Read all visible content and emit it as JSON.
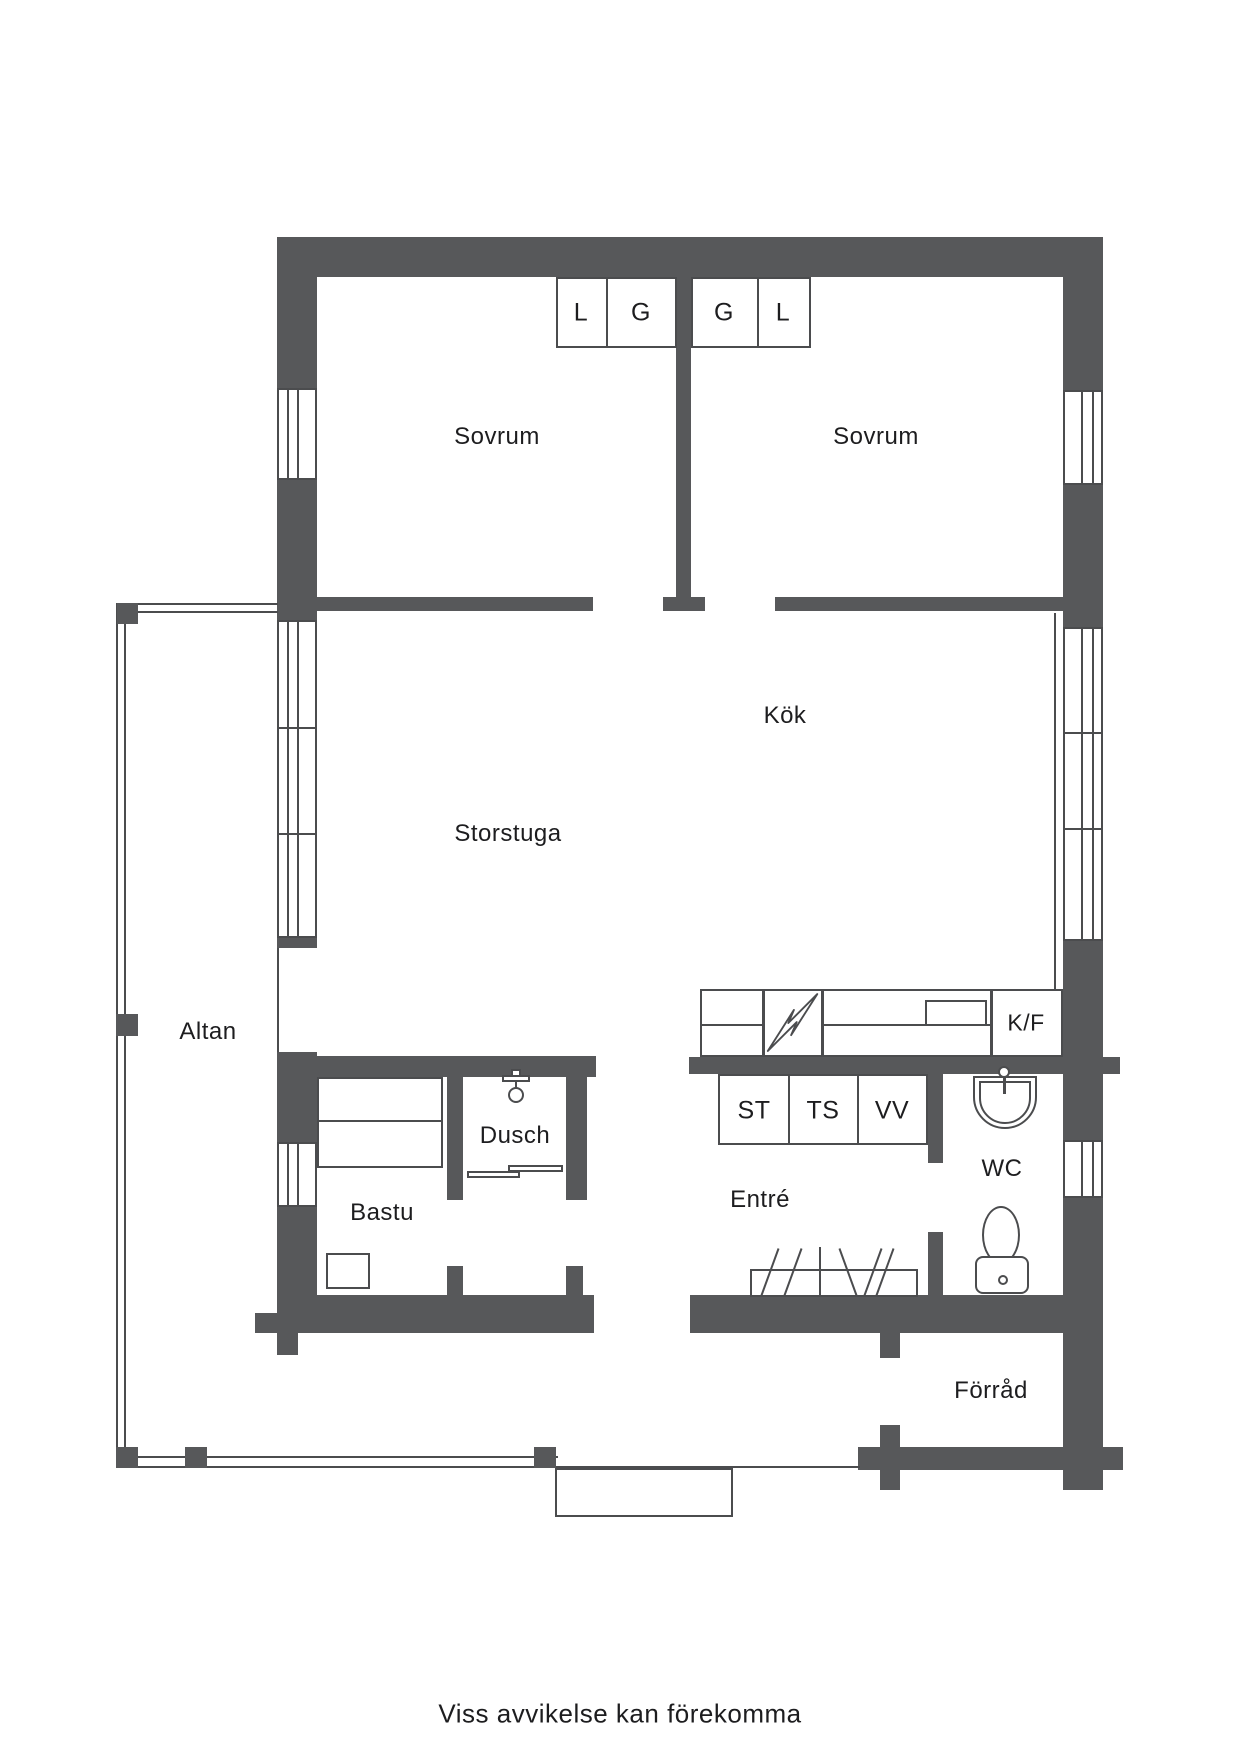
{
  "colors": {
    "wall": "#57585a",
    "line": "#4b4c4e",
    "text": "#1d1d1f",
    "background": "#ffffff"
  },
  "rooms": {
    "sovrum_left": "Sovrum",
    "sovrum_right": "Sovrum",
    "storstuga": "Storstuga",
    "kok": "Kök",
    "altan": "Altan",
    "dusch": "Dusch",
    "bastu": "Bastu",
    "entre": "Entré",
    "wc": "WC",
    "forrad": "Förråd"
  },
  "closets": {
    "l1": "L",
    "g1": "G",
    "g2": "G",
    "l2": "L",
    "st": "ST",
    "ts": "TS",
    "vv": "VV",
    "kf": "K/F"
  },
  "icons": {
    "stove": "lightning-bolt",
    "shower": "shower-head",
    "wc_sink": "sink",
    "wc_toilet": "toilet",
    "wardrobe": "hanger-marks"
  },
  "footer": {
    "note": "Viss avvikelse kan förekomma"
  }
}
